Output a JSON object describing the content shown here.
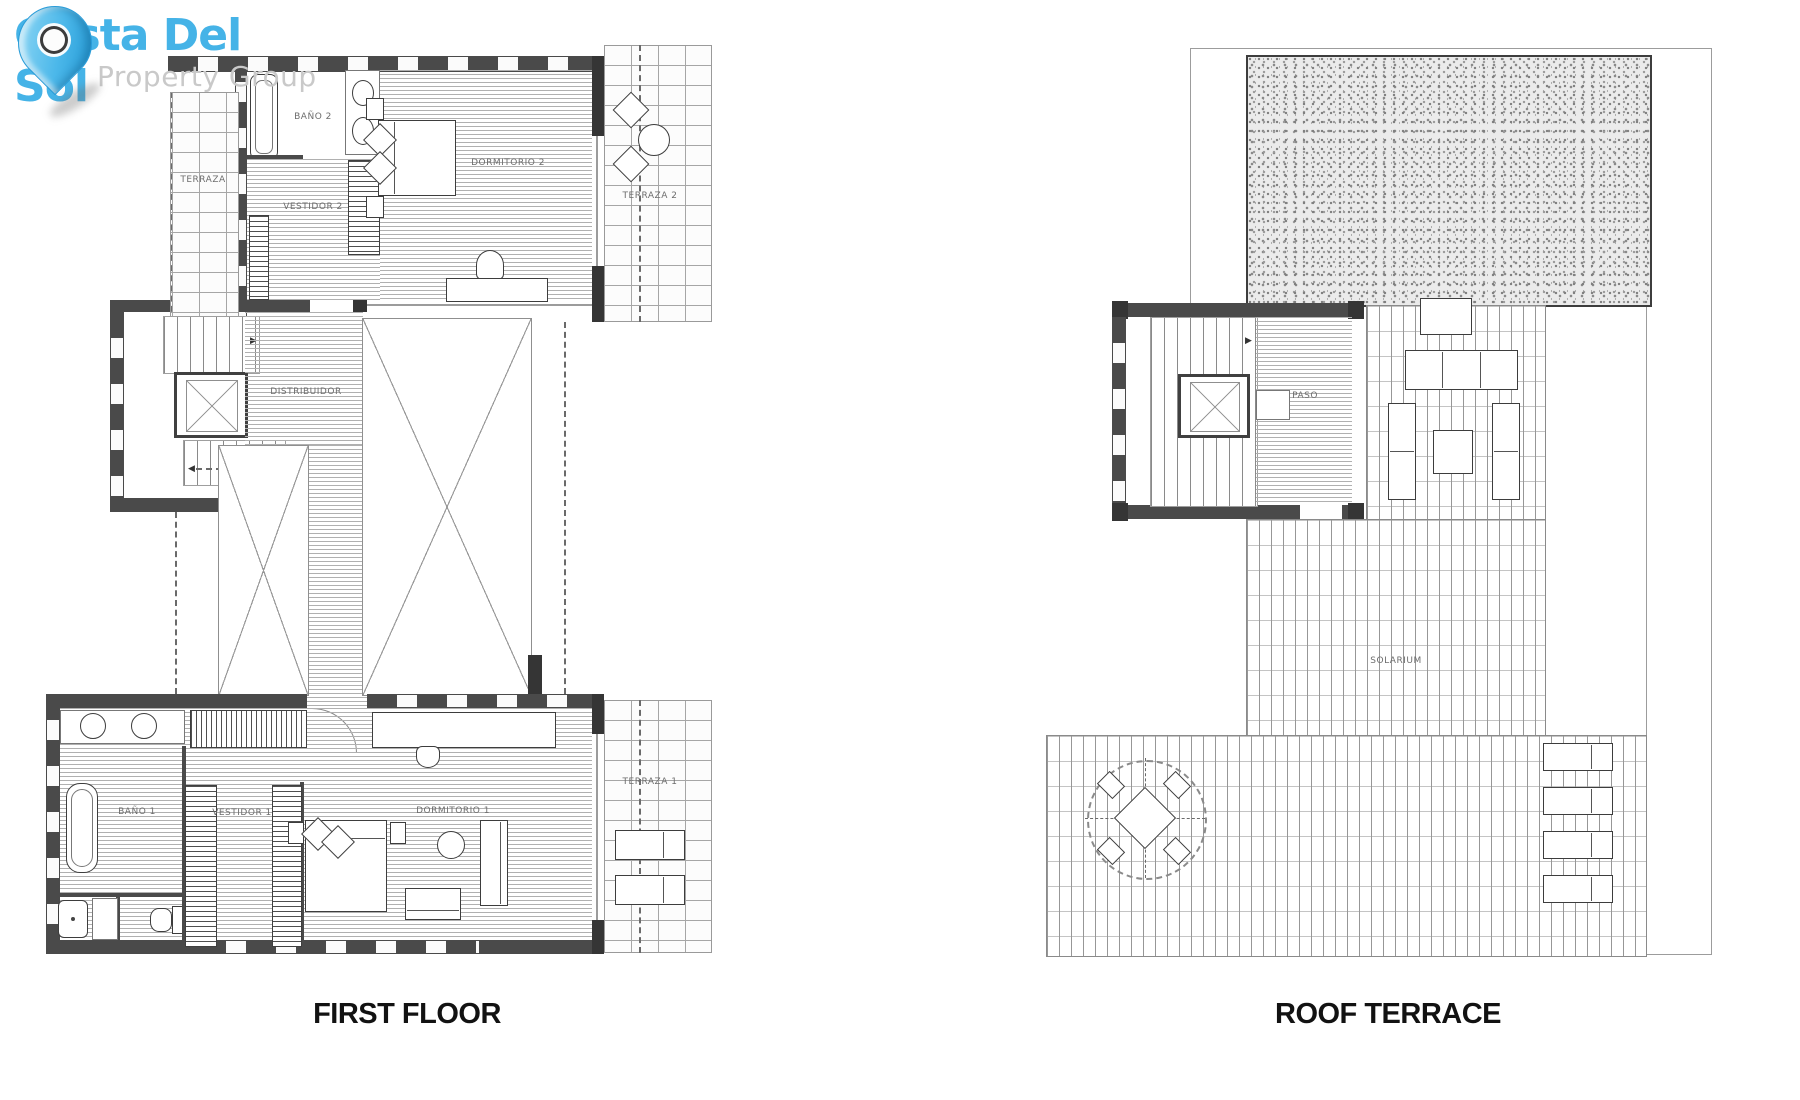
{
  "logo": {
    "brand": "Costa Del Sol",
    "subtitle": "Property Group",
    "brand_color": "#45b3e7",
    "subtitle_color": "#c9c9c9"
  },
  "plans": {
    "first_floor": {
      "title": "FIRST FLOOR",
      "rooms": {
        "terraza": "TERRAZA",
        "bano2": "BAÑO 2",
        "vestidor2": "VESTIDOR 2",
        "dormitorio2": "DORMITORIO 2",
        "terraza2": "TERRAZA 2",
        "distribuidor": "DISTRIBUIDOR",
        "bano1": "BAÑO 1",
        "vestidor1": "VESTIDOR 1",
        "dormitorio1": "DORMITORIO 1",
        "terraza1": "TERRAZA 1"
      }
    },
    "roof_terrace": {
      "title": "ROOF TERRACE",
      "rooms": {
        "paso": "PASO",
        "solarium": "SOLARIUM"
      }
    }
  },
  "colors": {
    "wall": "#4a4a4a",
    "hatch": "#a6a6a6"
  }
}
